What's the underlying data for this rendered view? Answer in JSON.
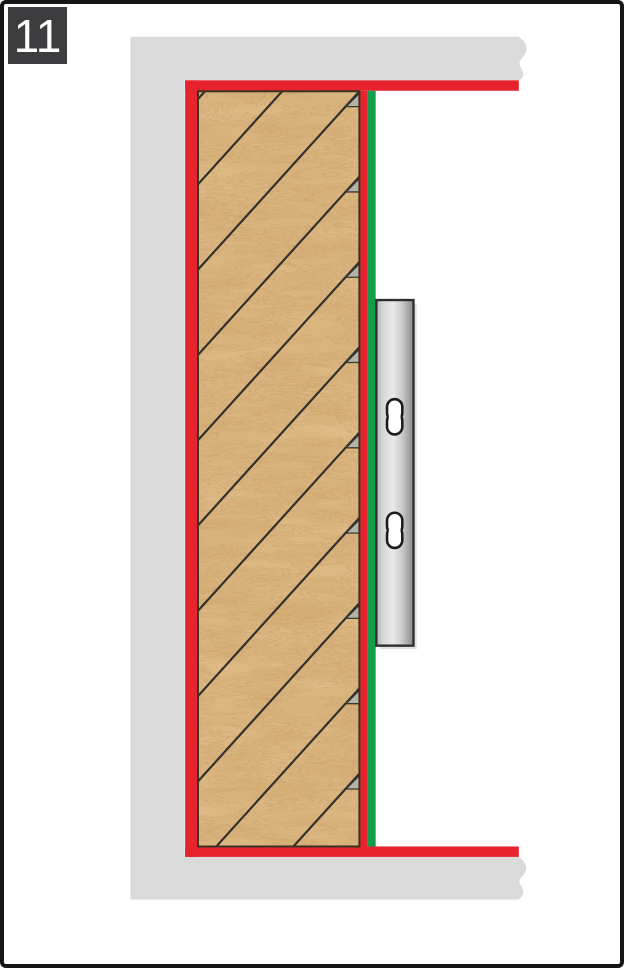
{
  "step": {
    "number": "11"
  },
  "colors": {
    "border": "#151515",
    "step_box_bg": "#3d3d3f",
    "step_box_text": "#ffffff",
    "wall_gray": "#dadada",
    "accent_red": "#e7232e",
    "accent_green": "#139c49",
    "wood_base": "#debb86",
    "wood_grain": "#c49760",
    "wood_grain_soft": "#caa066",
    "wood_outline": "#3c3222",
    "hatch_line": "#33302a",
    "notch_gray": "#b5b2a8",
    "notch_outline": "#3a372f",
    "rail_light": "#b2b2b2",
    "rail_mid": "#eaeaea",
    "rail_dark": "#878787",
    "rail_outline": "#2f2f2f",
    "rail_shadow": "#c8c8c8",
    "slot_fill": "#ffffff",
    "slot_outline": "#1c1c1c",
    "background": "#ffffff"
  }
}
